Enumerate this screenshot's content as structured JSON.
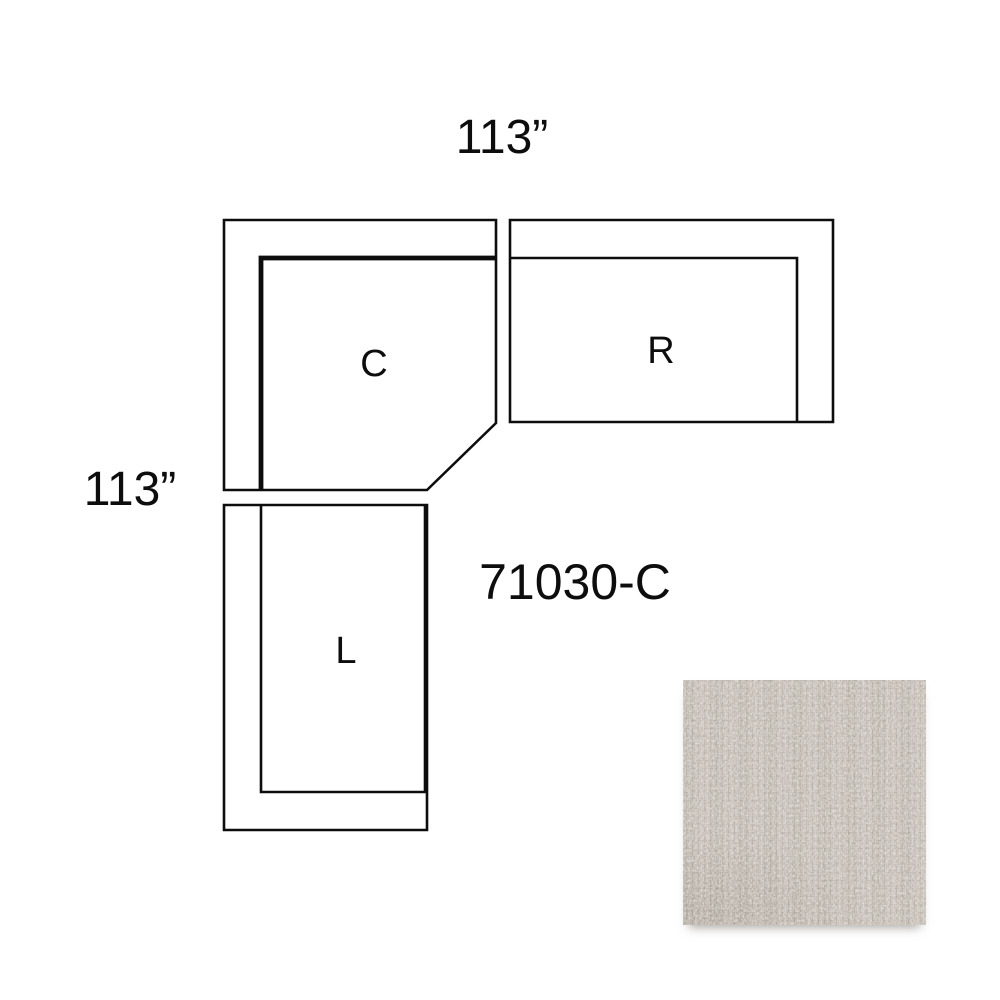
{
  "model_number": "71030-C",
  "dimensions": {
    "top": "113”",
    "left": "113”"
  },
  "pieces": [
    {
      "label": "C"
    },
    {
      "label": "R"
    },
    {
      "label": "L"
    }
  ],
  "colors": {
    "line": "#0d0d0d",
    "background": "#ffffff",
    "swatch_base": "#c2bbb3",
    "swatch_light": "#dad5ce",
    "swatch_dark": "#a89e94"
  }
}
